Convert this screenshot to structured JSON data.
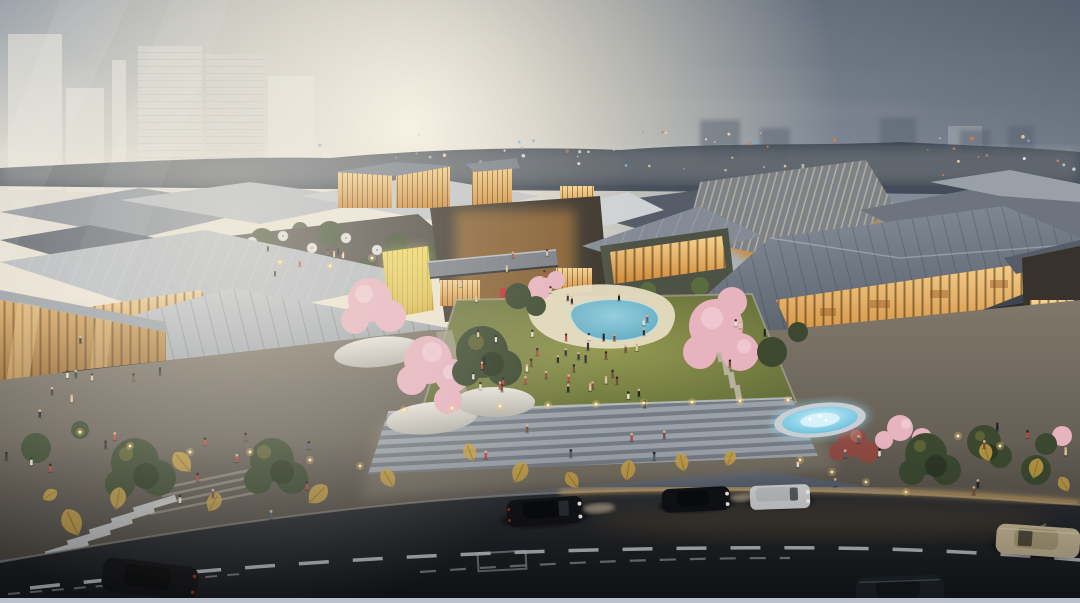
{
  "meta": {
    "type": "architectural-rendering",
    "scene_title": "Aerial dusk rendering of an open-air low-rise retail village with a central lawn plaza, pond, cherry blossoms, fountain and a curved street in the foreground",
    "time_of_day": "dusk"
  },
  "scene": {
    "sky": "Hazy dusk sky, warm sun glow left of center, ghosted high-rise towers at top-left, scattered city lights along the horizon",
    "village": "Low-rise retail buildings with large grey standing-seam roofs, warm glowing glazed facades, rooftop dining terrace with white parasols, a glowing timber lattice canopy, pedestrian bridge over a lane",
    "plaza": "Central lawn with gathered crowd, sand-edged blue pond, stepping-stone paths, cherry blossom trees in white planters, wide grey stairs, blue-lit fountain at right",
    "street": "Curved dark asphalt road with dashed lane markings, zebra crosswalk at left, sidewalk paving decorated with golden leaf motifs, several cars and pedestrians"
  },
  "palette": {
    "sky-top": "#57616f",
    "sky-mid": "#9aa2ab",
    "sky-horizon": "#e7e1d4",
    "sun-glow": "#fbf4e0",
    "city-silhouette": "#3e4653",
    "city-light-warm": "#f2d49a",
    "city-light-orange": "#e0793f",
    "city-light-cool": "#e8eaec",
    "ghost-tower": "#e9e7e0",
    "roof-light": "#b2b7be",
    "roof-mid": "#848b95",
    "roof-dark": "#565d68",
    "roof-slate": "#6d747e",
    "glass-warm": "#f7d28e",
    "glass-amber": "#cf8a39",
    "glass-deep": "#8a5a24",
    "gold-wall": "#e9cb4e",
    "facade-dark": "#33302b",
    "awning-dark": "#15131a",
    "sign-red": "#c03030",
    "living-wall": "#5d7040",
    "lawn-light": "#949a52",
    "lawn-dark": "#5a6534",
    "tree-green": "#3c4930",
    "tree-shadow": "#2c3724",
    "blossom-pink": "#e6b3bf",
    "blossom-light": "#f2cdd5",
    "blossom-maroon": "#8e4a42",
    "planter-white": "#e0ddd6",
    "sand": "#e6dcc2",
    "pool-blue": "#6fb4c9",
    "fountain-blue": "#5fc0dd",
    "pavement-warm": "#80786a",
    "pavement-dark": "#4e4a44",
    "stair-light": "#9ba1a8",
    "stair-dark": "#747b83",
    "leaf-gold": "#c9a245",
    "crosswalk-white": "#d9dcdf",
    "road-dark": "#17191c",
    "road-mid": "#2c2f34",
    "lane-white": "#d8dcdf",
    "curb-glow": "#e9b767",
    "car-black": "#121316",
    "car-white": "#d6d7d7",
    "car-beige": "#cfc09d",
    "car-green": "#20262a",
    "skin": "#d8b08a",
    "bottom-strip": "#c5cbd5"
  },
  "crowds": {
    "zones": [
      {
        "name": "lawn-crowd",
        "x": 470,
        "y": 332,
        "w": 168,
        "h": 66,
        "n": 30
      },
      {
        "name": "lawn-scatter",
        "x": 436,
        "y": 302,
        "w": 330,
        "h": 106,
        "n": 12
      },
      {
        "name": "alley",
        "x": 450,
        "y": 252,
        "w": 116,
        "h": 54,
        "n": 7
      },
      {
        "name": "roof-terrace",
        "x": 250,
        "y": 238,
        "w": 148,
        "h": 38,
        "n": 8
      },
      {
        "name": "stairs",
        "x": 424,
        "y": 430,
        "w": 326,
        "h": 32,
        "n": 6
      },
      {
        "name": "sidewalk-left",
        "x": 150,
        "y": 424,
        "w": 168,
        "h": 98,
        "n": 9
      },
      {
        "name": "far-left-walk",
        "x": 6,
        "y": 388,
        "w": 118,
        "h": 86,
        "n": 8
      },
      {
        "name": "left-storefront-walk",
        "x": 62,
        "y": 336,
        "w": 128,
        "h": 58,
        "n": 6
      },
      {
        "name": "right-walk",
        "x": 950,
        "y": 428,
        "w": 118,
        "h": 68,
        "n": 6
      },
      {
        "name": "fountain-walk",
        "x": 772,
        "y": 440,
        "w": 108,
        "h": 54,
        "n": 5
      },
      {
        "name": "poolside",
        "x": 560,
        "y": 300,
        "w": 96,
        "h": 44,
        "n": 6
      }
    ]
  },
  "lights": {
    "city_lights": {
      "count": 78,
      "x_min": 305,
      "x_max": 1078,
      "y_min": 130,
      "y_max": 176
    },
    "bollard_lights": 24
  },
  "vehicles": {
    "count": 6,
    "list": [
      "dark suv center",
      "dark sedan right",
      "white van right",
      "beige sedan bottom-right",
      "dark car bottom-left",
      "dark car bottom-right-edge"
    ]
  }
}
